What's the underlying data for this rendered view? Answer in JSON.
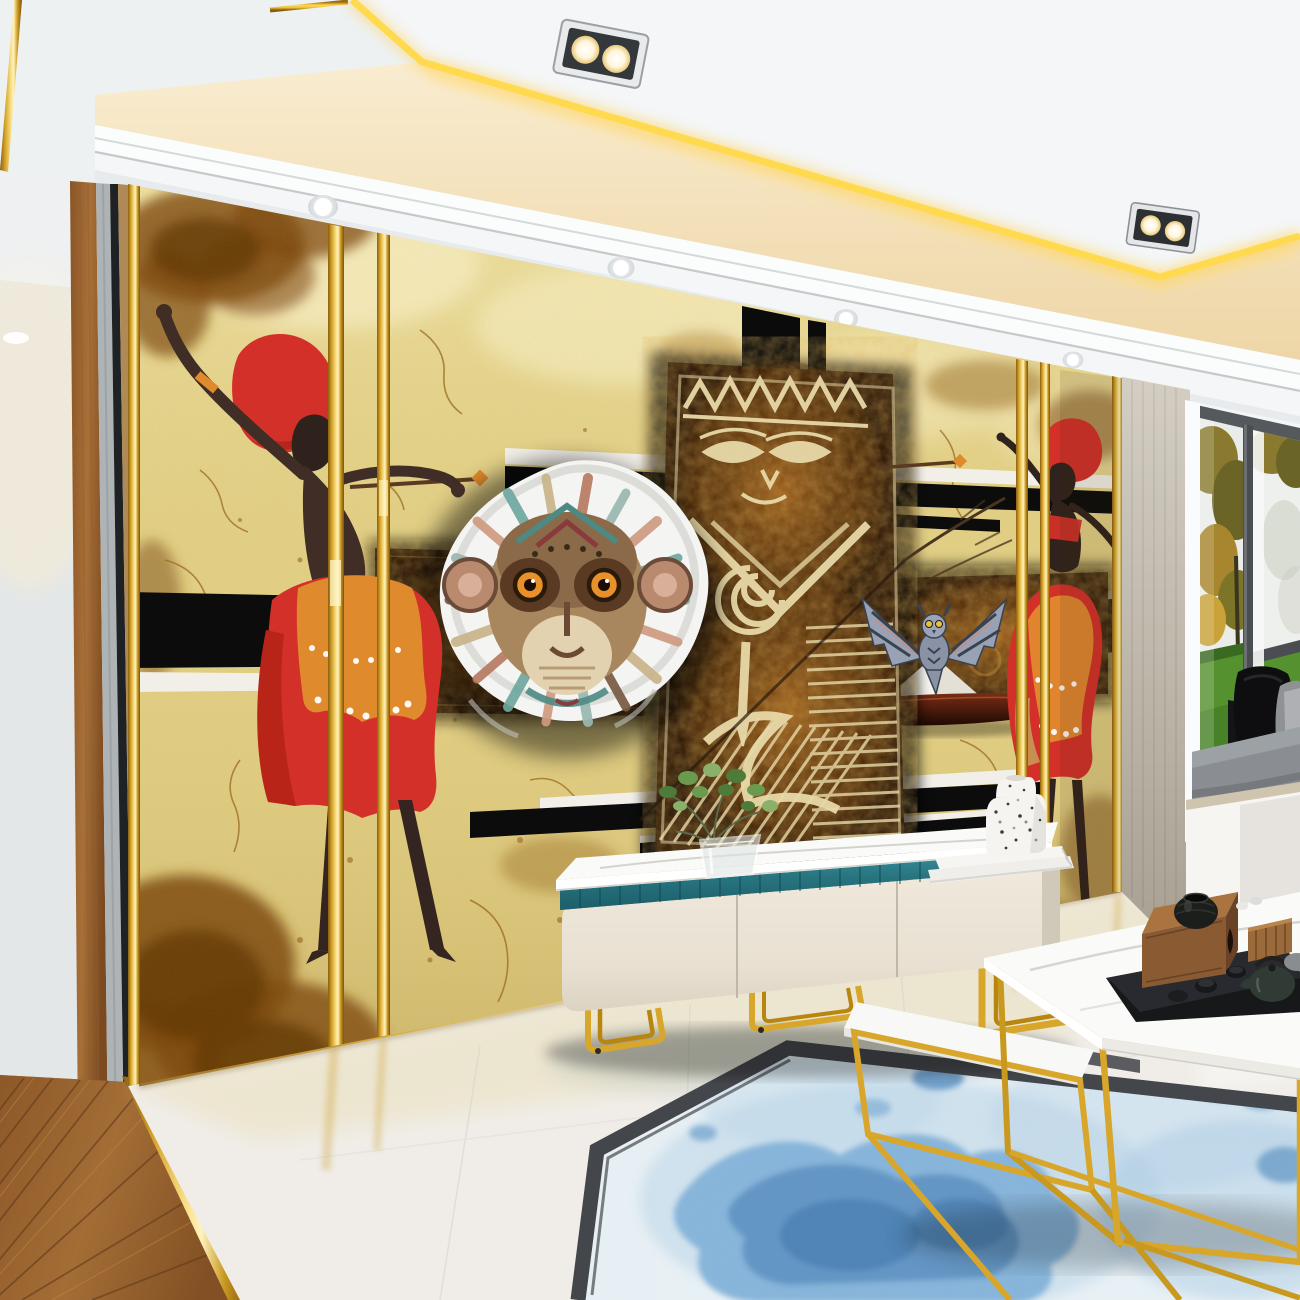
{
  "scene": {
    "kind": "3d-interior-render",
    "room": "living room with African tribal mural feature wall"
  },
  "palette": {
    "ceiling_white": "#eef1f2",
    "cove_cream": "#f5e7c6",
    "gold": "#d8a62a",
    "gold_bright": "#ffd94e",
    "wall_parchment": "#e3d186",
    "stain_brown": "#7e4a10",
    "stripe_black": "#0c0c0c",
    "stripe_white": "#f2efe8",
    "panel_dark": "#241104",
    "totem_cream": "#e8d9a8",
    "dancer_red": "#d23028",
    "dancer_orange": "#e08a2e",
    "silhouette_brown": "#3f2d26",
    "medallion_paper": "#f4f4f2",
    "cabinet_cream": "#ece5d8",
    "cabinet_teal": "#27747f",
    "marble_top": "#fafaf8",
    "floor_marble": "#f0ede8",
    "wood_floor": "#96642f",
    "rug_field": "#eaf2f6",
    "rug_blue": "#7fb0d8",
    "rug_border": "#43464a",
    "window_frame": "#55595d",
    "grass_green": "#55922f",
    "foliage_olive": "#8a7a30",
    "cushion_grey": "#8a8e92",
    "side_wall_beige": "#c9c2b6",
    "tray_black": "#17181a",
    "teapot_green": "#2f3b34",
    "box_wood": "#8a5a33"
  },
  "objects": [
    {
      "name": "coffered-ceiling",
      "detail": "white tray ceiling with gold LED strip"
    },
    {
      "name": "ceiling-spotlight-duo",
      "detail": "chrome twin-bulb recessed fixture"
    },
    {
      "name": "soffit-downlights",
      "detail": "four round recessed lights"
    },
    {
      "name": "mural-wall",
      "detail": "cracked parchment African art wallpaper"
    },
    {
      "name": "left-dancer",
      "detail": "silhouette woman, red head wrap, red-orange skirt"
    },
    {
      "name": "right-dancer",
      "detail": "smaller silhouette woman with red wrap"
    },
    {
      "name": "tribal-monkey-medallion",
      "detail": "colorful ethnic monkey face on torn paper disc"
    },
    {
      "name": "totem-panel",
      "detail": "dark carved tiki totem with cream pattern"
    },
    {
      "name": "ornate-dark-panels",
      "detail": "two dark ornamental rectangles"
    },
    {
      "name": "tribal-owl",
      "detail": "patterned owl with spread wings"
    },
    {
      "name": "boat-silhouette",
      "detail": "dark hull with white peak"
    },
    {
      "name": "black-white-stripes",
      "detail": "horizontal graphic bands"
    },
    {
      "name": "gold-wall-strips",
      "detail": "vertical brass inlay trims"
    },
    {
      "name": "tv-cabinet",
      "detail": "cream unit, teal fluted band, marble top, gold legs"
    },
    {
      "name": "plant-in-glass-vase"
    },
    {
      "name": "terrazzo-vase-on-books"
    },
    {
      "name": "coffee-table-set",
      "detail": "nesting gold frame tables, marble tops"
    },
    {
      "name": "tea-tray-set",
      "detail": "black tray, wood caddy, green teapot, cups"
    },
    {
      "name": "watercolor-rug",
      "detail": "blue blot rug with dark border"
    },
    {
      "name": "marble-floor"
    },
    {
      "name": "wood-floor-hallway"
    },
    {
      "name": "hallway-door-panels"
    },
    {
      "name": "bay-window",
      "detail": "grey frame, autumn trees, green lawn"
    },
    {
      "name": "window-seat",
      "detail": "grey cushion, black pillows, white base"
    },
    {
      "name": "floor-pot",
      "detail": "small black bowl by window seat"
    }
  ]
}
